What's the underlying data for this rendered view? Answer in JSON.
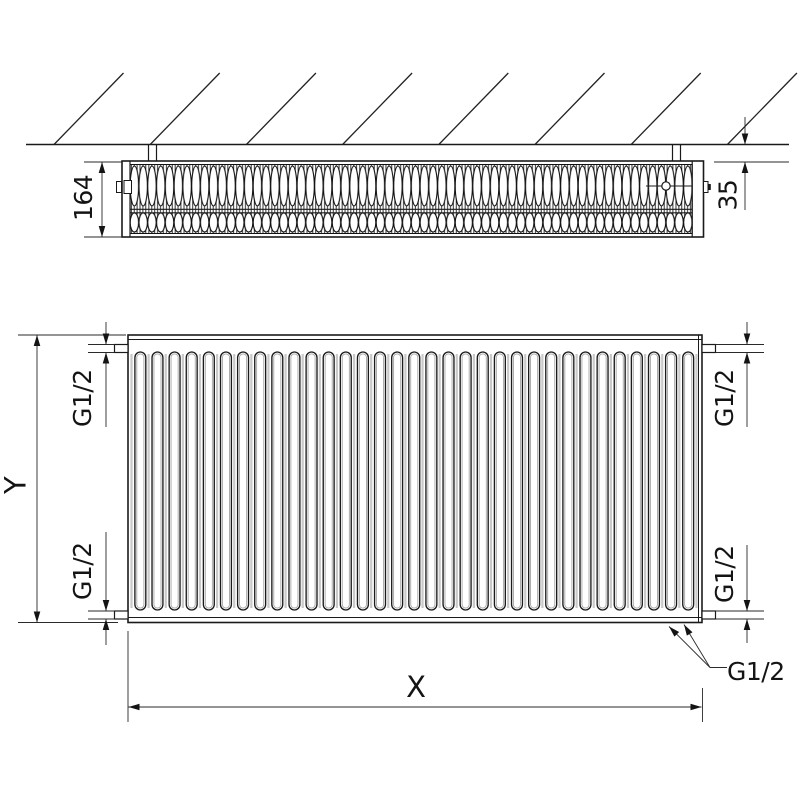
{
  "labels": {
    "top_view": {
      "depth": "164",
      "wall_distance": "35"
    },
    "front_view": {
      "width": "X",
      "height": "Y",
      "conn_top_left": "G1/2",
      "conn_bottom_left": "G1/2",
      "conn_top_right": "G1/2",
      "conn_bottom_right": "G1/2",
      "conn_bottom_center": "G1/2"
    }
  },
  "colors": {
    "ink": "#1a1a1a",
    "paper": "#ffffff"
  }
}
